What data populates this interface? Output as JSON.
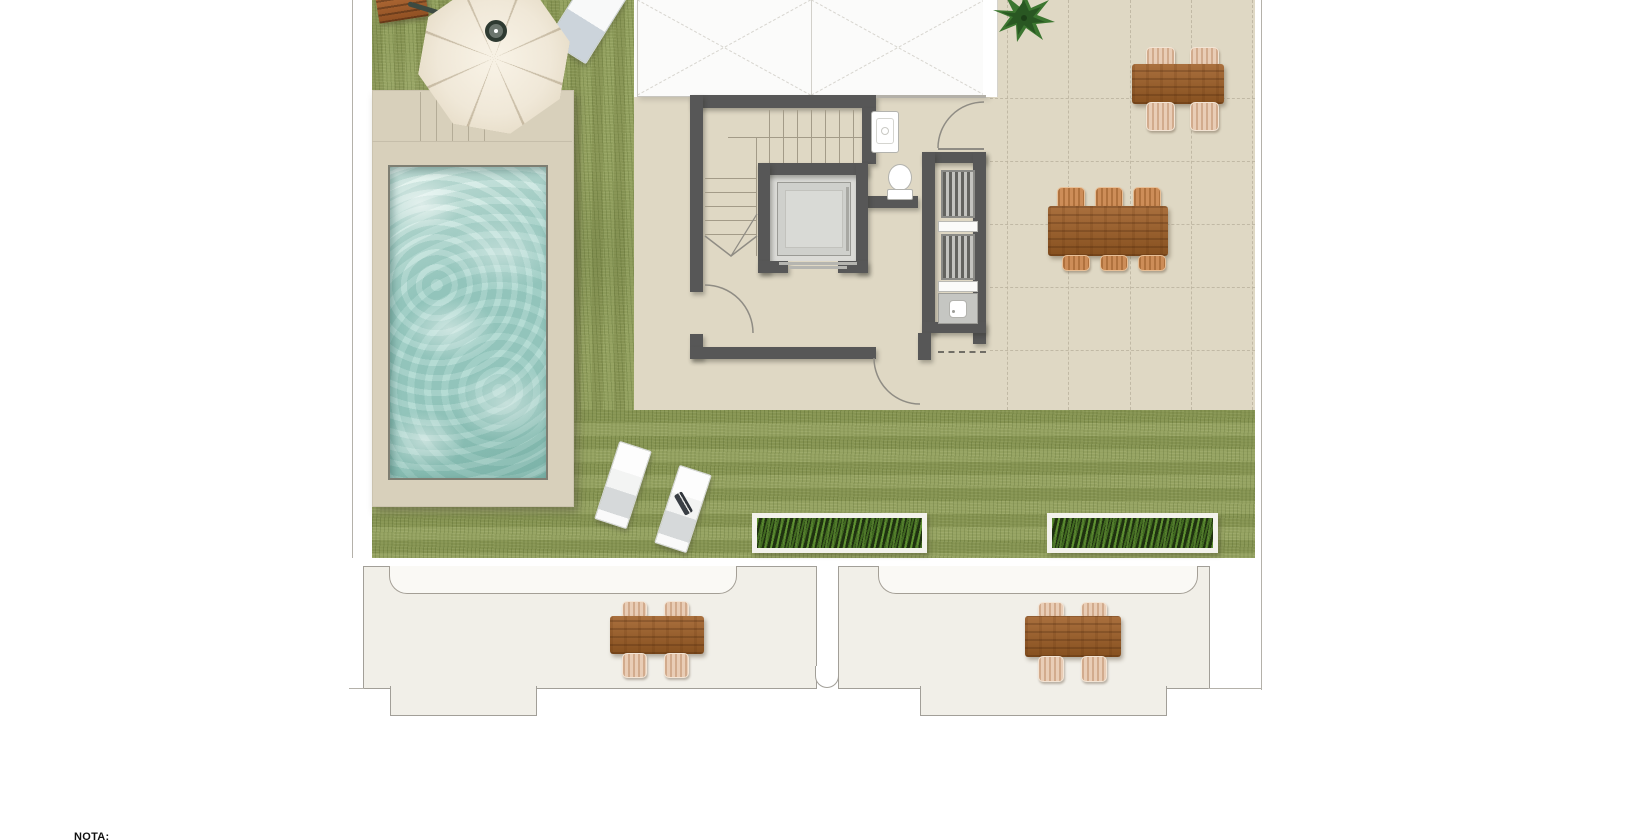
{
  "note": {
    "label": "NOTA:"
  },
  "palette": {
    "grass": "#8d9b57",
    "deck": "#d8d0bb",
    "terrace": "#dfd8c4",
    "terraceLine": "#bcb4a0",
    "lowerFloor": "#f1efe8",
    "wall": "#575757",
    "water": "#a2d2c9",
    "waterLight": "#e4f4ef",
    "waterDark": "#7fb7ac",
    "canopy": "#f0e8d8",
    "wicker": "#e9cdb6",
    "wickerOrange": "#cd8d58",
    "plantDark": "#1f3110",
    "skylight": "#fbfbfa",
    "skylightLine": "#d7d5cf",
    "cab": "#cfd0cc",
    "grillLine": "#63635f",
    "sinkUnit": "#c5c6c2"
  },
  "plan": {
    "areas": [
      "lawn",
      "pool-deck",
      "swimming-pool",
      "tiled-terrace",
      "stair-hall",
      "elevator",
      "bathroom",
      "outdoor-kitchen",
      "skylights",
      "lower-terraces"
    ],
    "furniture": [
      "cantilever-parasol",
      "wooden-bench",
      "sun-loungers",
      "dining-table-six-seats",
      "dining-table-four-seats",
      "planter-boxes",
      "toilet",
      "washbasin",
      "bbq-grills",
      "kitchen-sink"
    ]
  }
}
